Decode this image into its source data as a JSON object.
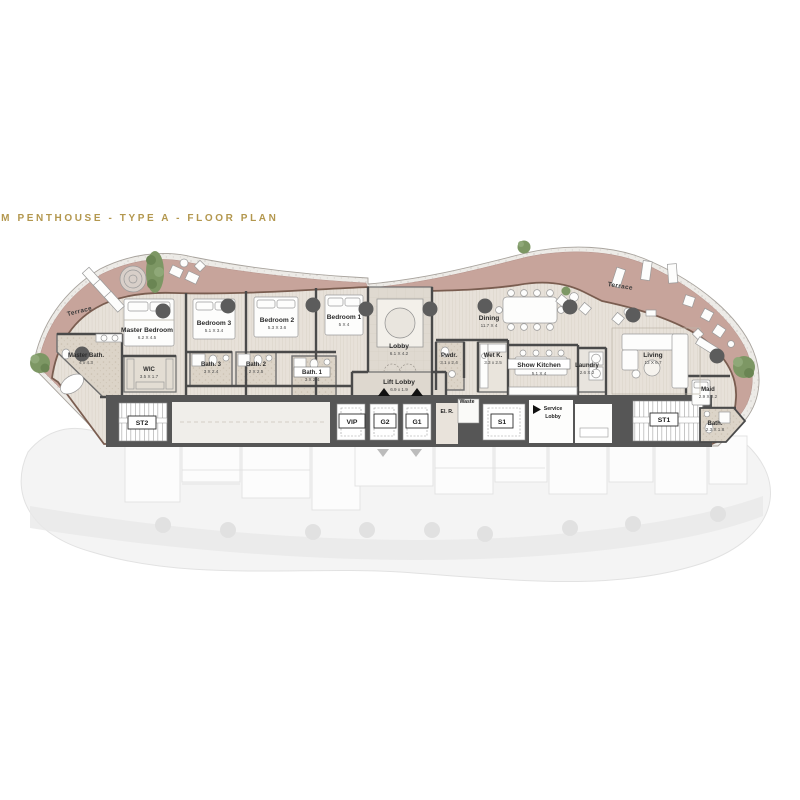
{
  "header": {
    "title": "4-BEDROOM PENTHOUSE - TYPE A - FLOOR PLAN"
  },
  "colors": {
    "title_gold": "#b3974e",
    "terrace_pink": "#c7a49b",
    "wall_gray": "#4f4f4f",
    "wood_floor": "#e7e1d9",
    "tree_green": "#7d9764",
    "ghost_gray": "#f3f3f3"
  },
  "labels": {
    "terrace_left": "Terrace",
    "terrace_right": "Terrace",
    "master_bath": {
      "name": "Master Bath.",
      "dim": "4 x 4.3"
    },
    "master_bedroom": {
      "name": "Master Bedroom",
      "dim": "6.2 X 4.5"
    },
    "wic": {
      "name": "WIC",
      "dim": "3.5 X 1.7"
    },
    "bedroom3": {
      "name": "Bedroom 3",
      "dim": "5.1 X 3.4"
    },
    "bath3": {
      "name": "Bath. 3",
      "dim": "3 X 2.4"
    },
    "bath2": {
      "name": "Bath. 2",
      "dim": "2 X 2.5"
    },
    "bedroom2": {
      "name": "Bedroom 2",
      "dim": "5.3 X 3.6"
    },
    "bath1": {
      "name": "Bath. 1",
      "dim": "3 X 2.4"
    },
    "bedroom1": {
      "name": "Bedroom 1",
      "dim": "5 X 4"
    },
    "lobby": {
      "name": "Lobby",
      "dim": "6.1 X 4.2"
    },
    "lift_lobby": {
      "name": "Lift Lobby",
      "dim": "6.9 x 1.9"
    },
    "pwdr": {
      "name": "Pwdr.",
      "dim": "3.1 x 2.4"
    },
    "wet_k": {
      "name": "Wet K.",
      "dim": "3.3 x 2.5"
    },
    "show_kitchen": {
      "name": "Show Kitchen",
      "dim": "5.1 X 4"
    },
    "dining": {
      "name": "Dining",
      "dim": "11.7 X 4"
    },
    "laundry": {
      "name": "Laundry",
      "dim": "2.6 X 2"
    },
    "living": {
      "name": "Living",
      "dim": "13 X 6.7"
    },
    "maid": {
      "name": "Maid",
      "dim": "2.9 X 2.2"
    },
    "bath_right": {
      "name": "Bath.",
      "dim": "2.3 X 1.8"
    },
    "st2": "ST2",
    "st1": "ST1",
    "vip": "VIP",
    "g2": "G2",
    "g1": "G1",
    "s1": "S1",
    "el_r": "El. R.",
    "waste": "Waste",
    "service_lobby": {
      "line1": "Service",
      "line2": "Lobby"
    }
  }
}
